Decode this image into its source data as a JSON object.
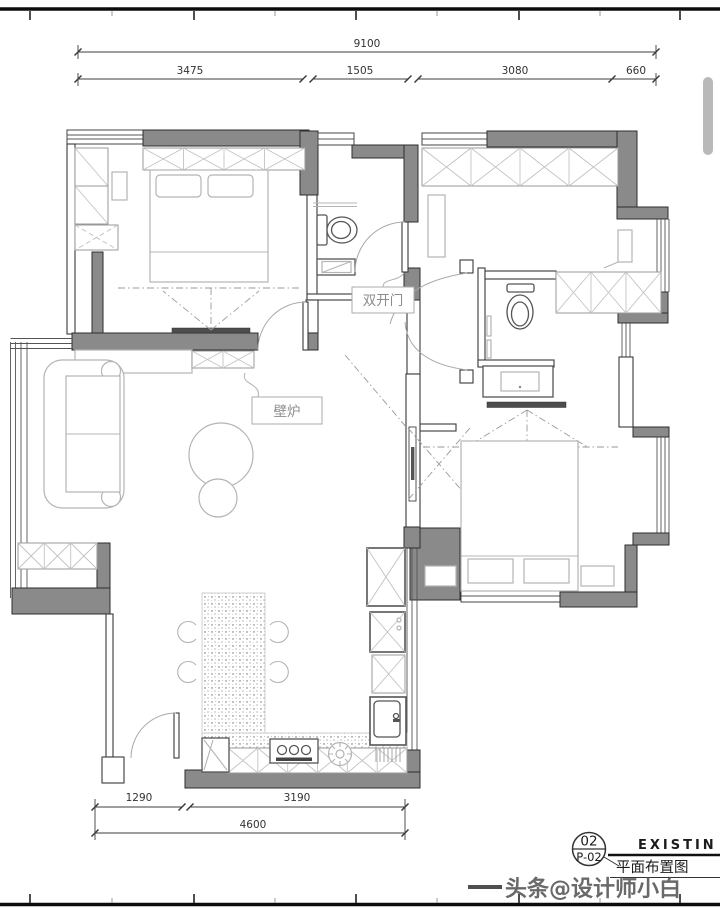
{
  "colors": {
    "wall-fill": "#8a8a8a",
    "wall-stroke": "#2e2e2e",
    "furniture": "#b4b4b4",
    "dim": "#3c3c3c",
    "dashdot": "#9a9a9a",
    "dark-item": "#4d4d4d",
    "watermark": "#4f4f4f",
    "scrollbar": "#b9b9b9"
  },
  "labels": {
    "double_door": "双开门",
    "fireplace": "壁炉"
  },
  "dimensions": {
    "top_total": "9100",
    "top_segments": [
      "3475",
      "1505",
      "3080",
      "660"
    ],
    "bottom_segments": [
      "1290",
      "3190"
    ],
    "bottom_total": "4600"
  },
  "title_block": {
    "sheet_number": "02",
    "sheet_code": "P-02",
    "drawing_title": "平面布置图",
    "drawing_title_en": "EXISTIN"
  },
  "watermark": "头条@设计师小白"
}
